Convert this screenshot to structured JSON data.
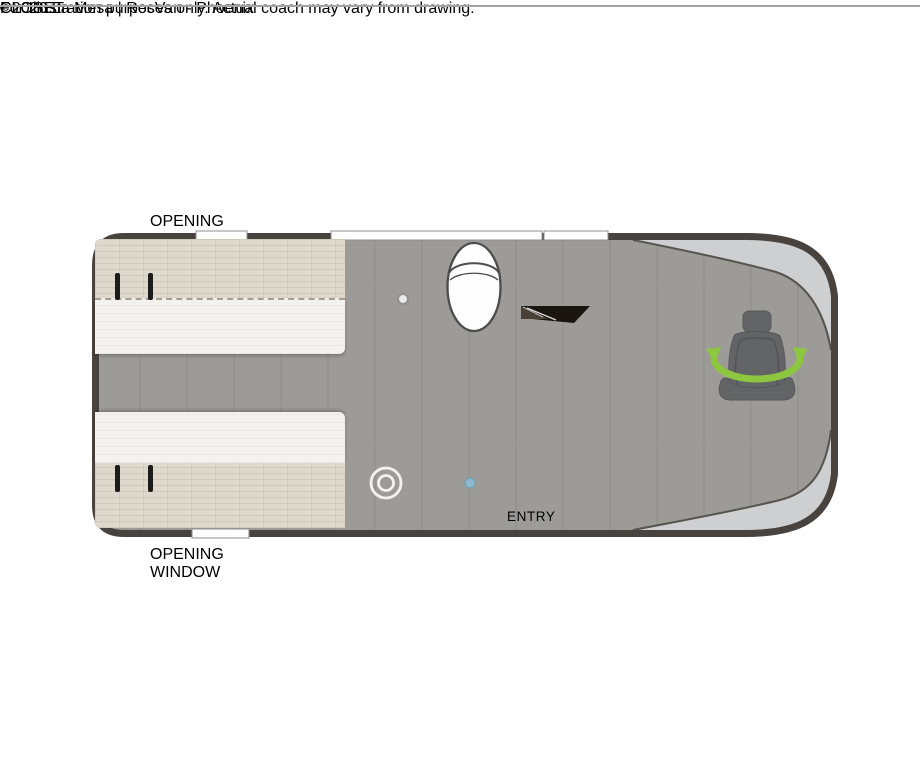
{
  "floorplan": {
    "window_labels": {
      "top": "OPENING WINDOW",
      "bottom": "OPENING WINDOW"
    },
    "bed": {
      "line1": "SOFAS CONVERT TO",
      "line2": "FULL WIDTH BED",
      "line3": "72\" x 66\""
    },
    "tv": "TV",
    "removable_table": {
      "line1": "REMOVABLE",
      "line2": "TABLE"
    },
    "closet": "CLOSET",
    "wet_bath": {
      "line1": "WET BATH",
      "line2": "38\" x 28\""
    },
    "micro": "MICRO",
    "fridge": "FRIDGE",
    "portable_cooktop": {
      "line1": "PORTABLE",
      "line2": "COOKTOP"
    },
    "swivel_chairs": {
      "line1": "SWIVEL",
      "line2": "CHAIRS"
    },
    "entry": "ENTRY",
    "colors": {
      "body_outline": "#48433f",
      "floor": "#9c9b97",
      "cab_highlight": "#cdcfd1",
      "wood_closet": "#7d6347",
      "wood_cabinet": "#a98a63",
      "swivel_green": "#8dc63f",
      "shower_blue": "#7fc6e6",
      "fridge_black": "#15110d",
      "sofa_cream": "#f3f2ee",
      "counter_cream": "#f2eee3",
      "sink_blue": "#a7cede"
    }
  },
  "footer": {
    "disclaimer": "For Illustration purposes only.  Actual coach may vary from drawing.",
    "watermark": "©2026 La Mesa | RecVan - Phoenix"
  }
}
